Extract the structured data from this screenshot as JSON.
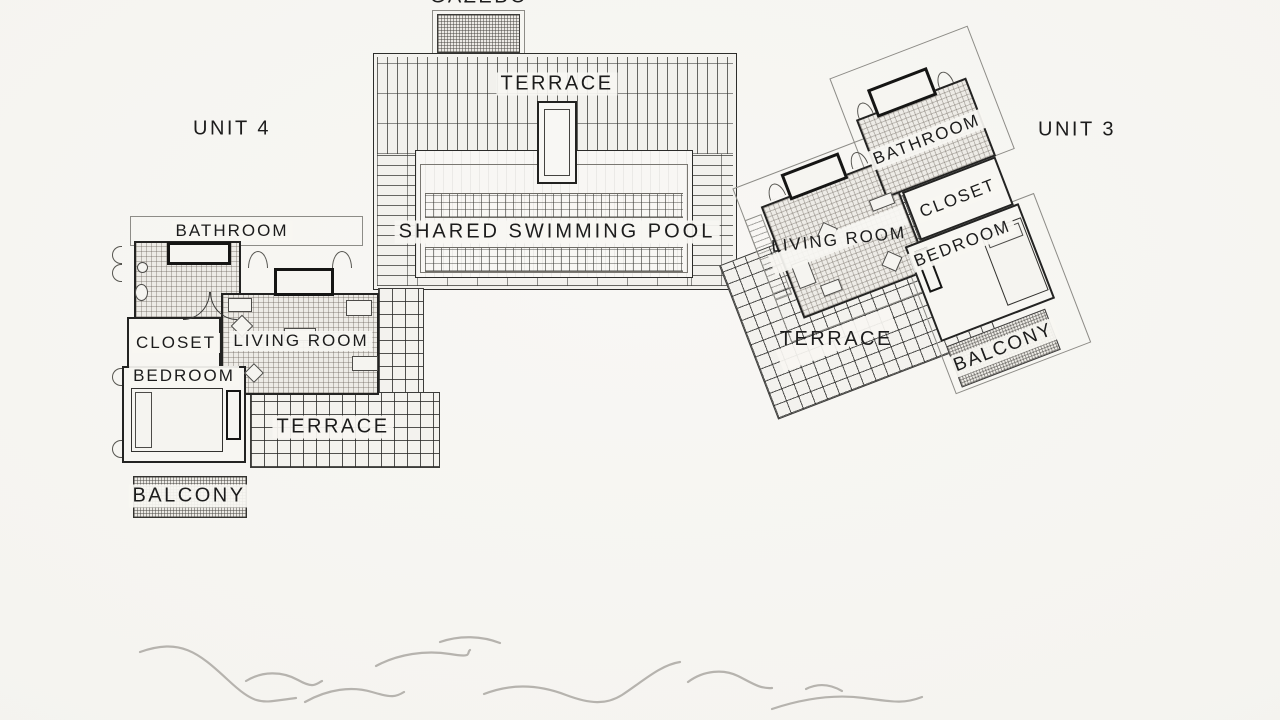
{
  "plan": {
    "gazebo_label": "GAZEBO",
    "shared_terrace_label": "TERRACE",
    "pool_label": "SHARED SWIMMING POOL"
  },
  "unit4": {
    "label": "UNIT 4",
    "rooms": {
      "bathroom": "BATHROOM",
      "closet": "CLOSET",
      "living_room": "LIVING ROOM",
      "bedroom": "BEDROOM",
      "terrace": "TERRACE",
      "balcony": "BALCONY"
    }
  },
  "unit3": {
    "label": "UNIT 3",
    "rooms": {
      "bathroom": "BATHROOM",
      "closet": "CLOSET",
      "living_room": "LIVING ROOM",
      "bedroom": "BEDROOM",
      "terrace": "TERRACE",
      "balcony": "BALCONY"
    }
  },
  "colors": {
    "paper": "#f5f4f0",
    "ink": "#1c1c1c",
    "grid_line": "#4a4a46",
    "wave": "#b6b3ae"
  }
}
